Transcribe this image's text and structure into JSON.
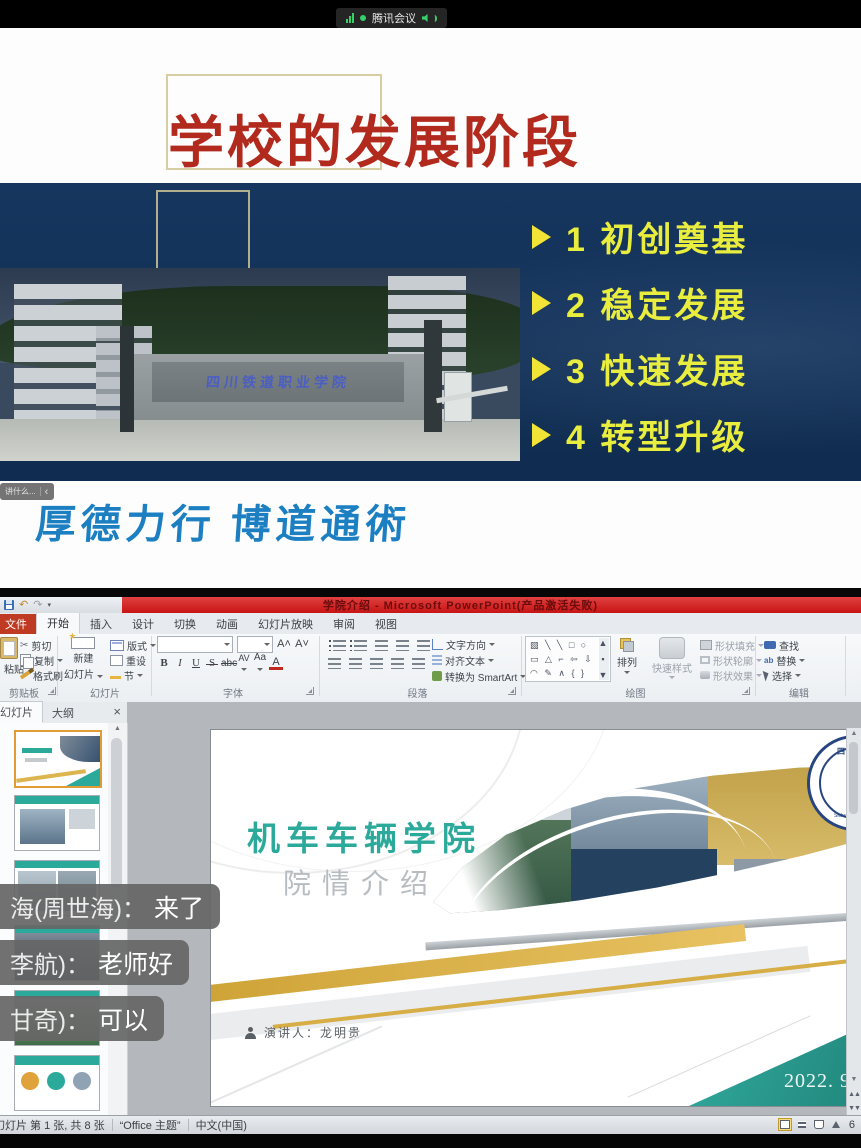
{
  "meeting": {
    "app_name": "腾讯会议"
  },
  "shared": {
    "title": "学校的发展阶段",
    "bullets": [
      "1 初创奠基",
      "2 稳定发展",
      "3 快速发展",
      "4 转型升级"
    ],
    "gate_sign": "四川铁道职业学院",
    "motto": "厚德力行  博道通術",
    "badge_text": "讲什么...",
    "badge_chevron": "‹"
  },
  "icons": {
    "undo": "↶",
    "redo": "↷",
    "scissors": "✂",
    "up": "▲",
    "down": "▼",
    "dbl_up": "▲▲",
    "dbl_down": "▼▼",
    "close": "×"
  },
  "ppt": {
    "title": "学院介绍 - Microsoft PowerPoint(产品激活失败)",
    "tabs": [
      "文件",
      "开始",
      "插入",
      "设计",
      "切换",
      "动画",
      "幻灯片放映",
      "审阅",
      "视图"
    ],
    "ribbon": {
      "clipboard": {
        "label": "剪贴板",
        "paste": "粘贴",
        "cut": "剪切",
        "copy": "复制",
        "painter": "格式刷"
      },
      "slides": {
        "label": "幻灯片",
        "new1": "新建",
        "new2": "幻灯片",
        "layout": "版式",
        "reset": "重设",
        "section": "节"
      },
      "font": {
        "label": "字体",
        "bold": "B",
        "italic": "I",
        "underline": "U",
        "shadow": "S",
        "strike": "abc",
        "spacing": "AV",
        "case": "Aa",
        "color": "A",
        "grow": "A",
        "shrink": "A"
      },
      "paragraph": {
        "label": "段落",
        "direction": "文字方向",
        "align_text": "对齐文本",
        "smartart": "转换为 SmartArt"
      },
      "drawing": {
        "label": "绘图",
        "arrange": "排列",
        "quick_styles": "快速样式",
        "fill": "形状填充",
        "outline": "形状轮廓",
        "effects": "形状效果",
        "shapes_row1": "▧ ╲ ╲ □ ○",
        "shapes_row2": "▭ △ ⌐ ⇦ ⇩",
        "shapes_row3": "◠ ✎ ∧ { }"
      },
      "editing": {
        "label": "编辑",
        "find": "查找",
        "replace": "替换",
        "select": "选择"
      }
    },
    "pane_tabs": {
      "slides": "幻灯片",
      "outline": "大纲"
    },
    "chat": [
      {
        "name": "海(周世海)",
        "colon": "：",
        "text": "来了"
      },
      {
        "name": "李航)",
        "colon": "：",
        "text": "老师好"
      },
      {
        "name": "甘奇)",
        "colon": "：",
        "text": "可以"
      }
    ],
    "slide": {
      "title": "机车车辆学院",
      "subtitle": "院情介绍",
      "presenter": "演讲人：龙明贵",
      "date": "2022. 9",
      "logo_cn": "四川铁道",
      "logo_year": "1952",
      "logo_en": "Sichuan Railway C"
    },
    "status": {
      "slide_info": "幻灯片 第 1 张, 共 8 张",
      "theme": "“Office 主题”",
      "language": "中文(中国)",
      "zoom": "6"
    }
  },
  "colors": {
    "navy_bg": "#14345c",
    "bullet_yellow": "#e9ed3e",
    "title_red": "#b22a1d",
    "motto_blue": "#1c7fc2",
    "titlebar_red": "#c81414",
    "teal": "#2ba99a",
    "gold": "#d9ae3f"
  }
}
